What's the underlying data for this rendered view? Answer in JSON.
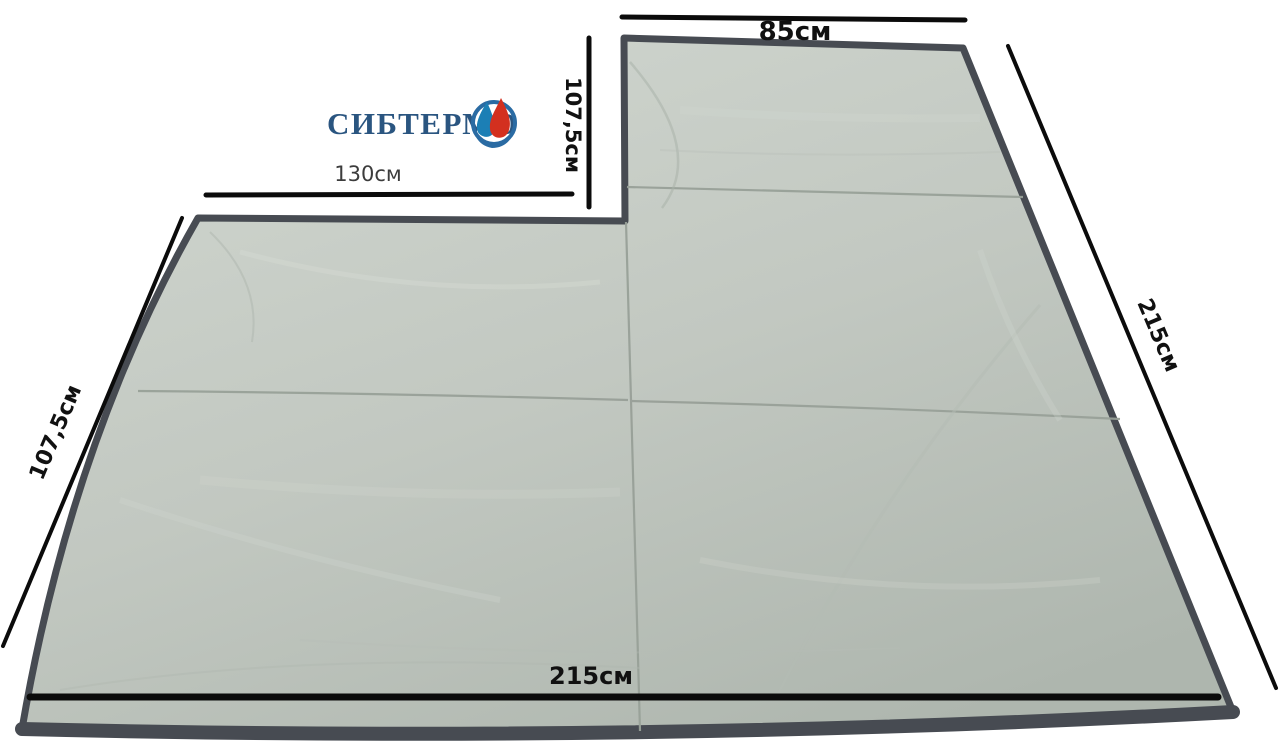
{
  "brand": {
    "name": "СИБТЕРМО"
  },
  "measurements": {
    "top_section_width": "85см",
    "top_section_depth": "107,5см",
    "main_top_width": "130см",
    "left_edge_length": "107,5см",
    "right_edge_length": "215см",
    "bottom_width": "215см"
  },
  "colors": {
    "background": "#ffffff",
    "fabric_light": "#d0d6cf",
    "fabric_mid": "#c2c8c1",
    "fabric_dark": "#aeb6ae",
    "edging": "#474b52",
    "seam": "#98a098",
    "dimension_line": "#0b0b0b",
    "label_text": "#111111",
    "secondary_label_text": "#3c3c3c",
    "brand_blue": "#2a5580",
    "logo_ring_blue": "#2a6ba3",
    "logo_drop_blue": "#1c7fb5",
    "logo_flame_red": "#d3301f"
  }
}
